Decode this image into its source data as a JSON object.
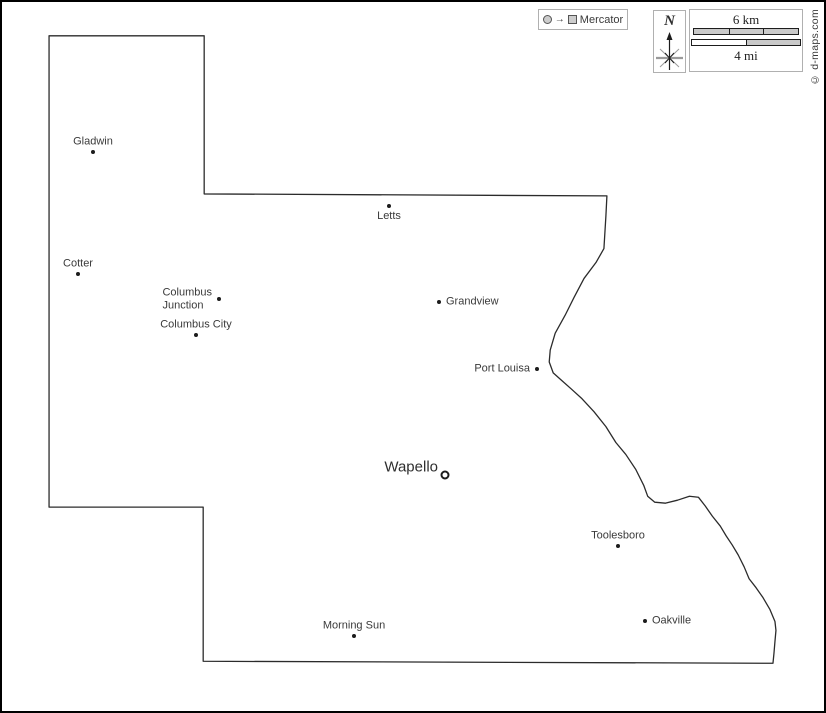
{
  "projection_legend": {
    "label": "Mercator"
  },
  "compass": {
    "north_label": "N"
  },
  "scale_bar": {
    "km_label": "6 km",
    "mi_label": "4 mi"
  },
  "copyright": "© d-maps.com",
  "colors": {
    "outline": "#2b2b2b",
    "marker": "#1c1c1c",
    "label_text": "#3a3a3a",
    "bar_fill": "#c9c9c9",
    "box_border": "#b0b0b0",
    "frame": "#000000"
  },
  "cities": [
    {
      "name": "Gladwin",
      "x": 91,
      "y": 150,
      "marker": "dot",
      "label_pos": "above"
    },
    {
      "name": "Letts",
      "x": 387,
      "y": 204,
      "marker": "dot",
      "label_pos": "below"
    },
    {
      "name": "Cotter",
      "x": 76,
      "y": 272,
      "marker": "dot",
      "label_pos": "above"
    },
    {
      "name": "Columbus\nJunction",
      "x": 217,
      "y": 297,
      "marker": "dot",
      "label_pos": "left"
    },
    {
      "name": "Columbus City",
      "x": 194,
      "y": 333,
      "marker": "dot",
      "label_pos": "above"
    },
    {
      "name": "Grandview",
      "x": 437,
      "y": 300,
      "marker": "dot",
      "label_pos": "right"
    },
    {
      "name": "Port Louisa",
      "x": 535,
      "y": 367,
      "marker": "dot",
      "label_pos": "left"
    },
    {
      "name": "Wapello",
      "x": 443,
      "y": 473,
      "marker": "ring",
      "label_pos": "left",
      "major": true,
      "dy": -8
    },
    {
      "name": "Toolesboro",
      "x": 616,
      "y": 544,
      "marker": "dot",
      "label_pos": "above"
    },
    {
      "name": "Oakville",
      "x": 643,
      "y": 619,
      "marker": "dot",
      "label_pos": "right"
    },
    {
      "name": "Morning Sun",
      "x": 352,
      "y": 634,
      "marker": "dot",
      "label_pos": "above"
    }
  ]
}
